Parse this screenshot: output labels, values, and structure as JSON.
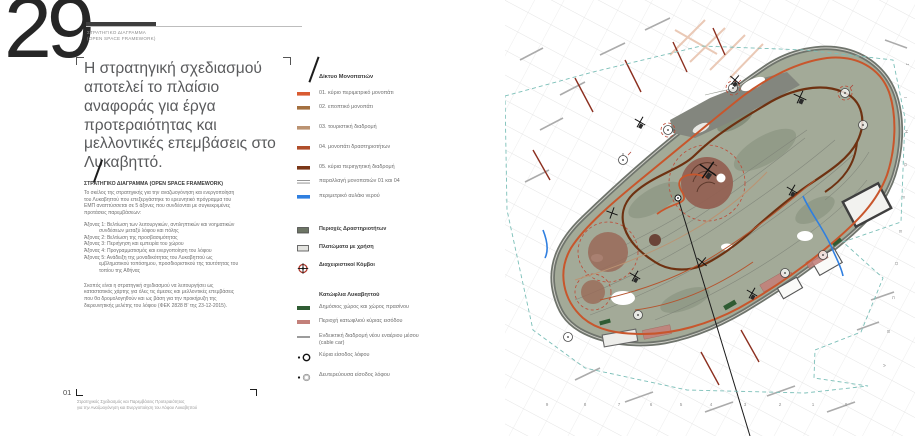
{
  "page": {
    "number": "29",
    "kicker_line1": "ΣΤΡΑΤΗΓΙΚΟ ΔΙΑΓΡΑΜΜΑ",
    "kicker_line2": "(OPEN SPACE FRAMEWORK)",
    "headline": "Η στρατηγική σχεδιασμού αποτελεί το πλαίσιο αναφοράς για έργα προτεραιότητας και μελλοντικές επεμβάσεις στο Λυκαβηττό.",
    "section_title": "ΣΤΡΑΤΗΓΙΚΟ ΔΙΑΓΡΑΜΜΑ (OPEN SPACE FRAMEWORK)",
    "body_intro": "Το σκέλος της στρατηγικής για την αναζωογόνηση και ενεργοποίηση του Λυκαβηττού που επεξεργάστηκε το ερευνητικό πρόγραμμα του ΕΜΠ αναπτύσσεται σε 5 άξονες που συνδέονται με συγκεκριμένες προτάσεις παρεμβάσεων:",
    "axes": [
      "Άξονας 1: Βελτίωση των λειτουργικών, αντιληπτικών και νοηματικών συνδέσεων μεταξύ λόφου και πόλης",
      "Άξονας 2: Βελτίωση της προσβασιμότητας",
      "Άξονας 3: Περιήγηση και εμπειρία του χώρου",
      "Άξονας 4: Προγραμματισμός και ενεργοποίηση του λόφου",
      "Άξονας 5: Ανάδειξη της μοναδικότητας του Λυκαβηττού ως εμβληματικού τοπόσημου, προσδιοριστικού της ταυτότητας του τοπίου της Αθήνας"
    ],
    "body_outro": "Σκοπός είναι η στρατηγική σχεδιασμού να λειτουργήσει ως καταστατικός χάρτης για όλες τις άμεσες και μελλοντικές επεμβάσεις που θα δρομολογηθούν και ως βάση για την προκήρυξη της διερευνητικής μελέτης του λόφου (ΦΕΚ 2828 Β' της 23-12-2015).",
    "footer_number": "01",
    "footer_line1": "Στρατηγικός Σχεδιασμός και Παρεμβάσεις Προτεραιότητας",
    "footer_line2": "για την Αναζωογόνηση και Ενεργοποίηση του Λόφου Λυκαβηττού"
  },
  "legend": {
    "group1_title": "Δίκτυο Μονοπατιών",
    "paths": [
      {
        "label": "01. κύριο περιμετρικό μονοπάτι",
        "color": "#d95b31"
      },
      {
        "label": "02. εποπτικό μονοπάτι",
        "color": "#a4703f"
      },
      {
        "label": "03. τουριστική διαδρομή",
        "color": "#bb9372"
      },
      {
        "label": "04. μονοπάτι δραστηριοτήτων",
        "color": "#b04e2a"
      },
      {
        "label": "05. κύρια περιηγητική διαδρομή",
        "color": "#7a3617"
      }
    ],
    "variant": {
      "label": "παραλλαγή μονοπατιών 01 και 04",
      "color": "#8a8a8a"
    },
    "water": {
      "label": "περιμετρικό αυλάκι νερού",
      "color": "#2f7fe0"
    },
    "areas": [
      {
        "label": "Περιοχές Δραστηριοτήτων",
        "color": "#6d7565"
      },
      {
        "label": "Πλατώματα με χρήση",
        "color": "#e4e4e0"
      }
    ],
    "nodes": {
      "label": "Διαχειριστικοί Κόμβοι",
      "color": "#b03a2e"
    },
    "group2_title": "Κατώφλια Λυκαβηττού",
    "thresholds": [
      {
        "label": "Δημόσιος χώρος και χώρος πρασίνου",
        "color": "#2f5c33"
      },
      {
        "label": "Περιοχή κατωφλιού κύριας εισόδου",
        "color": "#c3807a"
      }
    ],
    "cablecar": {
      "label": "Ενδεικτική διαδρομή νέου εναέριου μέσου (cable car)",
      "color": "#222222"
    },
    "entrances": [
      {
        "label": "Κύρια είσοδος λόφου"
      },
      {
        "label": "Δευτερεύουσα είσοδος λόφου"
      }
    ]
  },
  "map": {
    "grid_letters": [
      "J",
      "I",
      "H",
      "G",
      "F",
      "E",
      "D",
      "C",
      "B",
      "A"
    ],
    "grid_numbers": [
      "9",
      "8",
      "7",
      "6",
      "5",
      "4",
      "3",
      "2",
      "1",
      "0"
    ],
    "colors": {
      "hill": "#a3aa98",
      "hill_road": "#6f746c",
      "peak_gray": "#83867e",
      "theater_brown": "#926051",
      "boundary_teal": "#7bbfb8",
      "dashed_red": "#bf4a36",
      "stream_blue": "#2f7fe0",
      "main_path": "#c8562c",
      "tour_path": "#6e3111"
    }
  }
}
